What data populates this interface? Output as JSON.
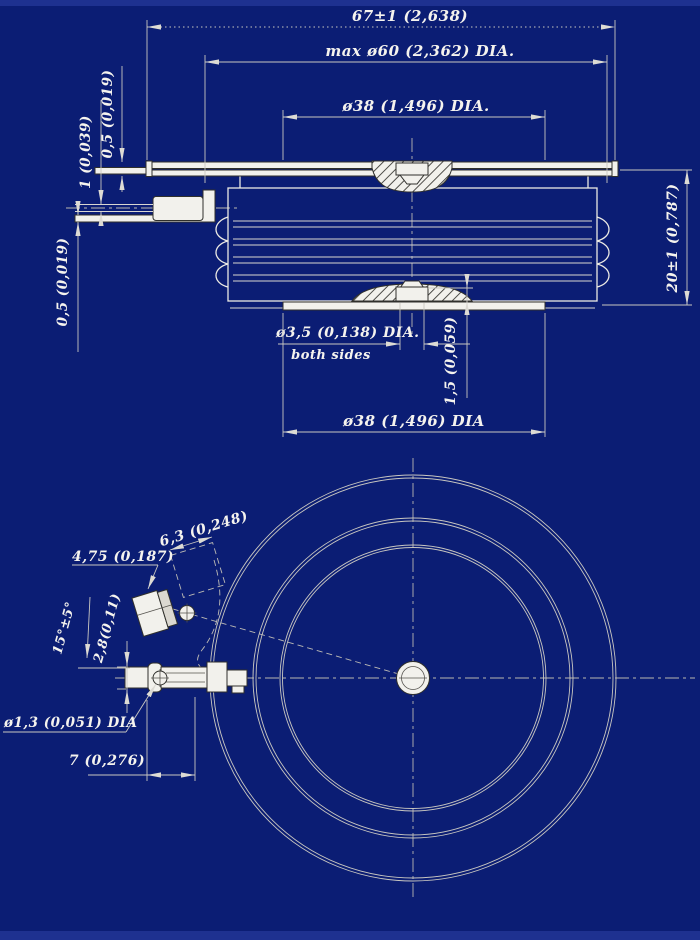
{
  "colors": {
    "background": "#0b1d74",
    "edge_strip": "#1e3190",
    "drawing_line": "#eceae4",
    "dimension_line": "#c9c7c1",
    "text": "#f5f3ee",
    "shape_fill": "#f2f1ec",
    "shape_stroke": "#30302c"
  },
  "side_view": {
    "dim_overall_width": "67±1 (2,638)",
    "dim_max_diameter": "max ø60 (2,362) DIA.",
    "dim_pole_diameter_top": "ø38 (1,496) DIA.",
    "dim_height": "20±1 (0,787)",
    "dim_flange_thickness": "0,5 (0,019)",
    "dim_lead_diameter": "1 (0,039)",
    "dim_strip_thickness": "0,5 (0,019)",
    "dim_gate_diameter": "ø3,5 (0,138) DIA.",
    "dim_gate_note": "both sides",
    "dim_gate_height": "1,5 (0,059)",
    "dim_pole_diameter_bottom": "ø38 (1,496) DIA"
  },
  "bottom_view": {
    "dim_tab_width": "4,75 (0,187)",
    "dim_housing_width": "6,3 (0,248)",
    "dim_lead_angle": "15°±5°",
    "dim_terminal_offset": "2,8(0,11)",
    "dim_hole_diameter": "ø1,3 (0,051) DIA",
    "dim_lead_spacing": "7 (0,276)"
  }
}
